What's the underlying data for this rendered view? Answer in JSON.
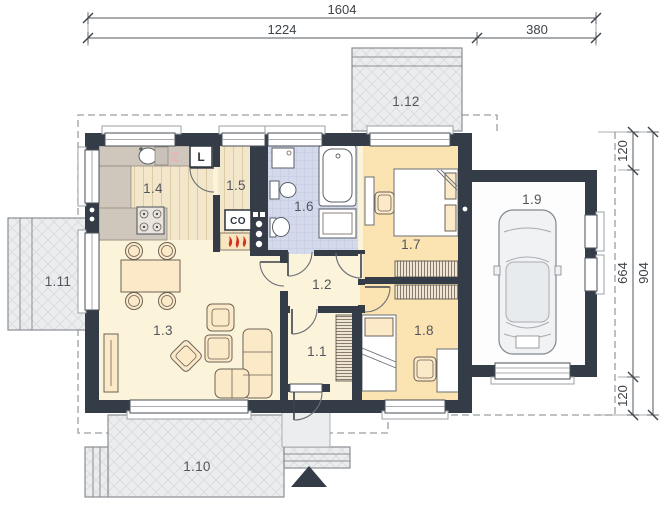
{
  "dims": {
    "top_total": "1604",
    "top_main": "1224",
    "top_garage": "380",
    "right_overhang_top": "120",
    "right_side": "664",
    "right_total": "904",
    "right_overhang_bottom": "120"
  },
  "rooms": [
    "1.1",
    "1.2",
    "1.3",
    "1.4",
    "1.5",
    "1.6",
    "1.7",
    "1.8",
    "1.9",
    "1.10",
    "1.11",
    "1.12"
  ],
  "appliances": {
    "dishwasher": "Z",
    "fridge": "L",
    "boiler": "CO"
  },
  "colors": {
    "wall": "#343d47",
    "floor_living": "#fbf3da",
    "floor_wood": "#f3e7cb",
    "floor_bedroom": "#fbe3b2",
    "floor_bath": "#d4daec",
    "terrace": "#ecedee",
    "counter": "#d0c7bc",
    "furniture": "#fce9c8",
    "flame": "#d43324",
    "garage_floor": "#fdfdfe"
  }
}
